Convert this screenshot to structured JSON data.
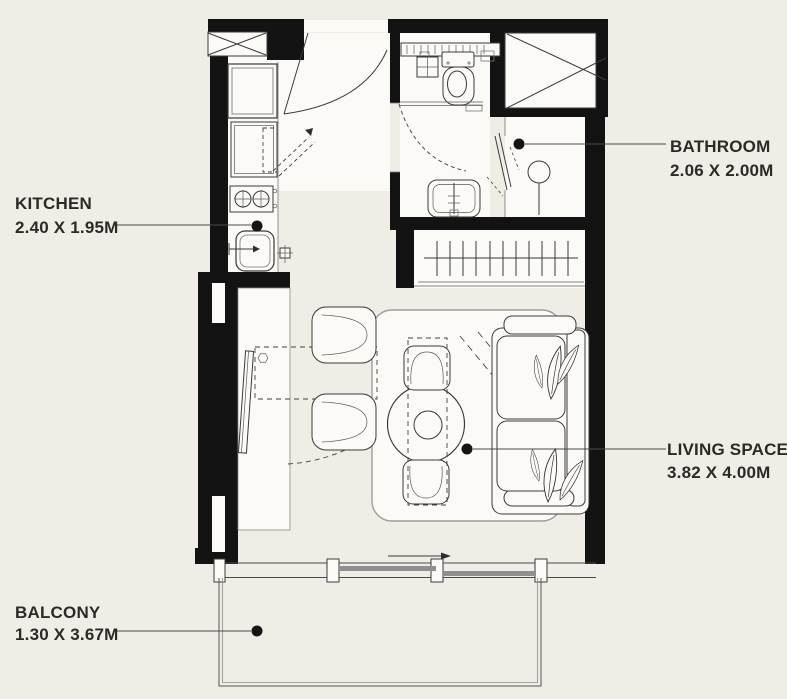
{
  "rooms": {
    "kitchen": {
      "name": "KITCHEN",
      "dimensions": "2.40 X 1.95M"
    },
    "bathroom": {
      "name": "BATHROOM",
      "dimensions": "2.06 X 2.00M"
    },
    "living_space": {
      "name": "LIVING SPACE",
      "dimensions": "3.82 X 4.00M"
    },
    "balcony": {
      "name": "BALCONY",
      "dimensions": "1.30 X 3.67M"
    }
  },
  "colors": {
    "background": "#f0ede6",
    "floor": "#fbfaf7",
    "wall": "#131313",
    "line": "#3a3a3a",
    "text": "#2b2a27",
    "sliding_panel": "#8f8f8f"
  }
}
